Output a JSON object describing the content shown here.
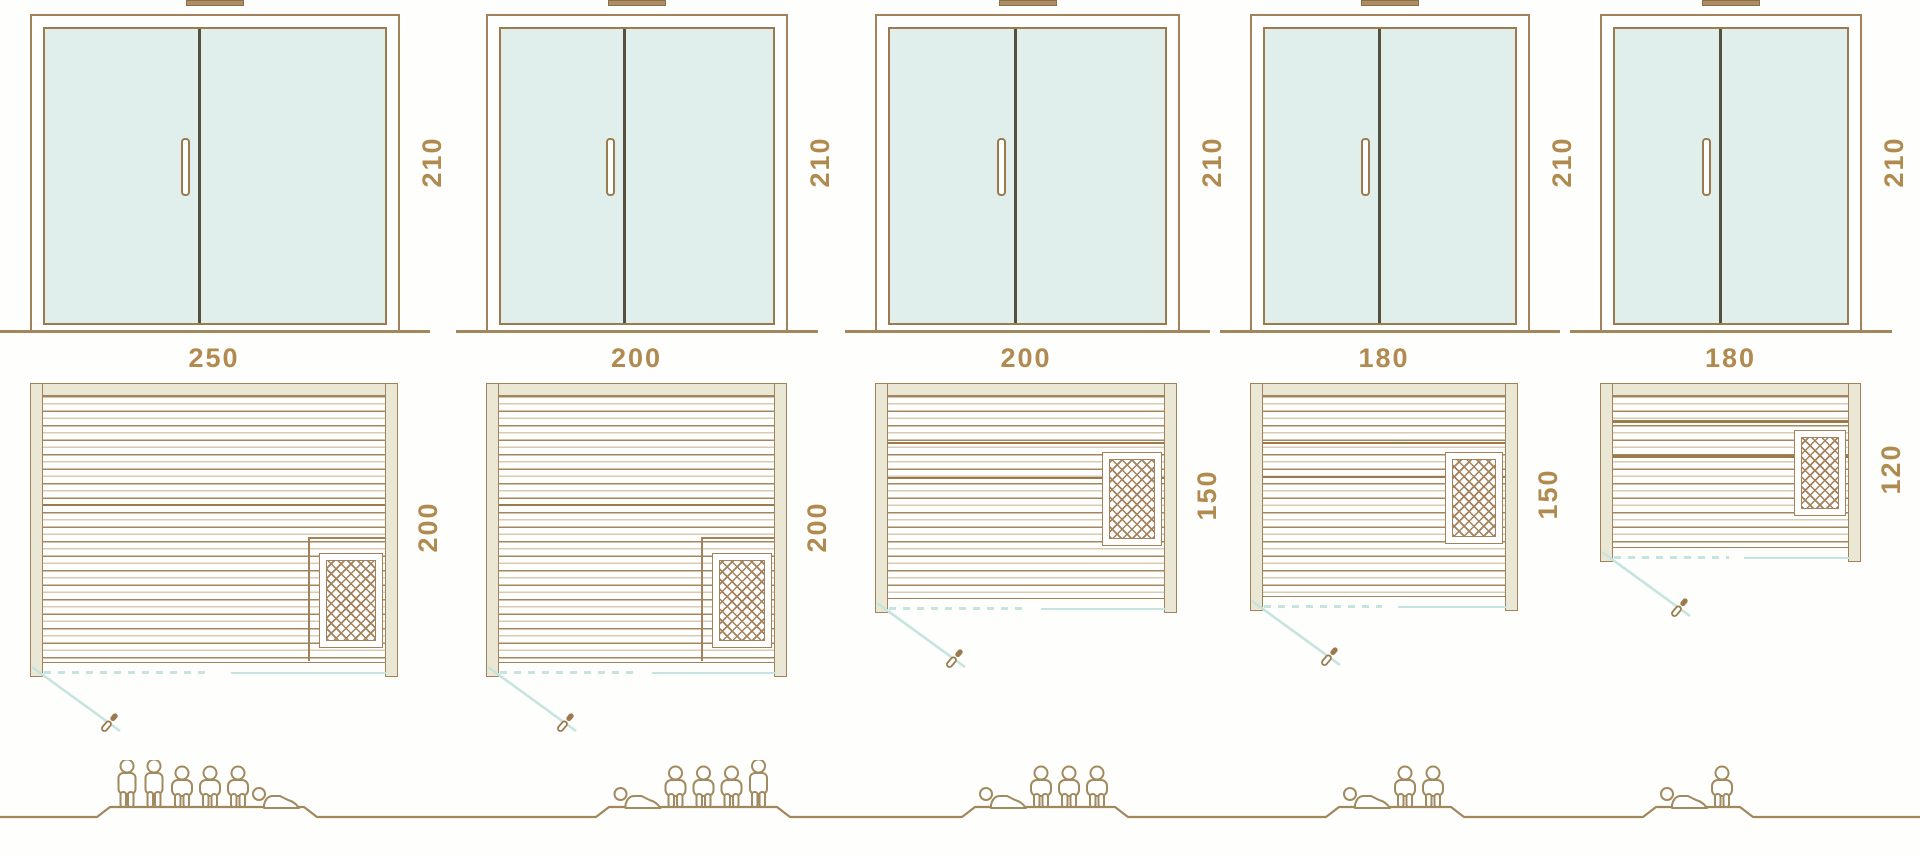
{
  "diagram_type": "sauna-size-comparison",
  "dimension_unit_note": "values as printed on drawing",
  "colors": {
    "outline": "#a3815a",
    "dimension_text": "#b08a4e",
    "glass": "#e1efec",
    "wall_fill": "#eae7d4",
    "door_swing_teal": "#c6e4df",
    "door_divider": "#55503e",
    "ground_line": "#a3875c"
  },
  "models": [
    {
      "height_label": "210",
      "width_label": "250",
      "depth_label": "200",
      "capacity": 6,
      "figures": [
        "standing",
        "standing",
        "sitting",
        "sitting",
        "sitting",
        "lying"
      ]
    },
    {
      "height_label": "210",
      "width_label": "200",
      "depth_label": "200",
      "capacity": 5,
      "figures": [
        "lying",
        "sitting",
        "sitting",
        "sitting",
        "standing"
      ]
    },
    {
      "height_label": "210",
      "width_label": "200",
      "depth_label": "150",
      "capacity": 4,
      "figures": [
        "lying",
        "sitting",
        "sitting",
        "sitting"
      ]
    },
    {
      "height_label": "210",
      "width_label": "180",
      "depth_label": "150",
      "capacity": 3,
      "figures": [
        "lying",
        "sitting",
        "sitting"
      ]
    },
    {
      "height_label": "210",
      "width_label": "180",
      "depth_label": "120",
      "capacity": 2,
      "figures": [
        "lying",
        "sitting"
      ]
    }
  ]
}
